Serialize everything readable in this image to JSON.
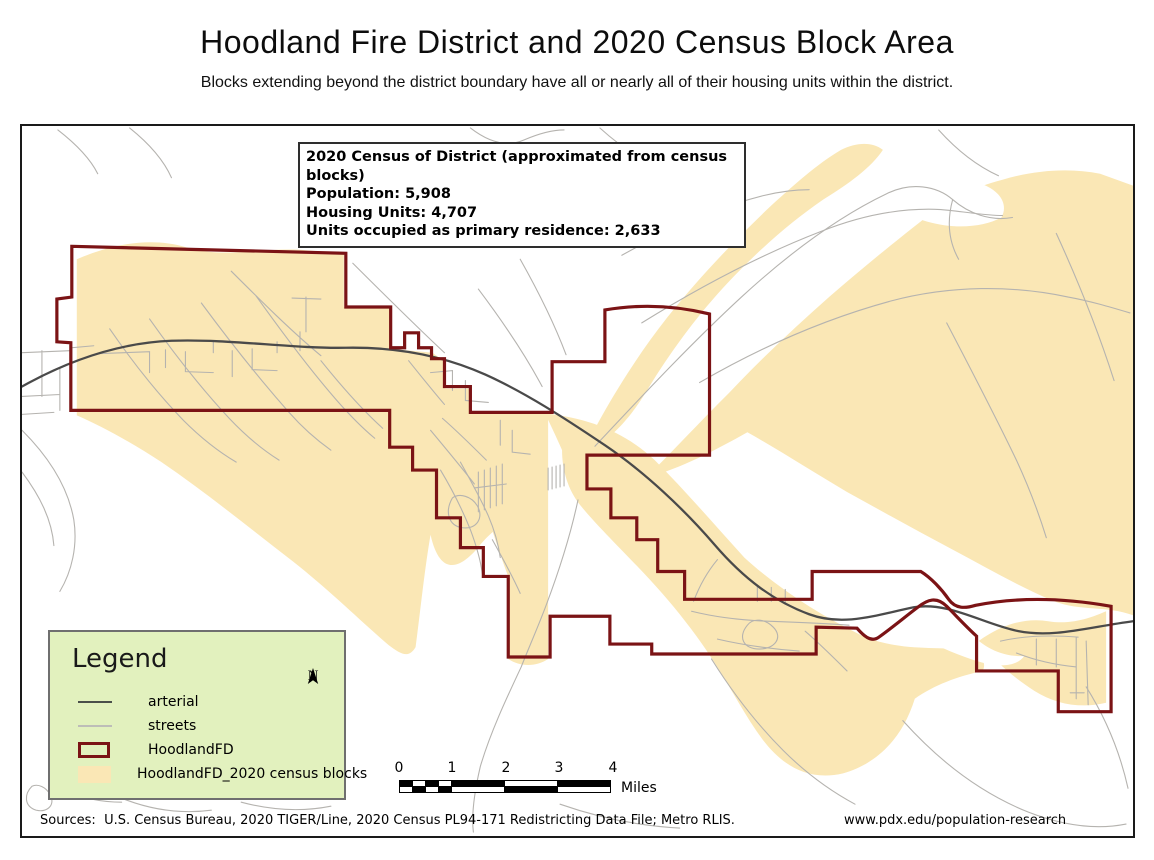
{
  "page": {
    "title": "Hoodland Fire District and 2020 Census Block Area",
    "subtitle": "Blocks extending beyond the district boundary have all or nearly all of their housing units within the district."
  },
  "map": {
    "info_box": {
      "heading": "2020 Census of District (approximated from census blocks)",
      "population": "Population: 5,908",
      "housing_units": "Housing Units: 4,707",
      "occupied": "Units occupied as primary residence: 2,633"
    },
    "legend": {
      "title": "Legend",
      "north_label": "N",
      "items": [
        {
          "label": "arterial",
          "swatch": "line-dark"
        },
        {
          "label": "streets",
          "swatch": "line-light"
        },
        {
          "label": "HoodlandFD",
          "swatch": "outline-maroon"
        },
        {
          "label": "HoodlandFD_2020 census blocks",
          "swatch": "fill-tan"
        }
      ]
    },
    "scale_bar": {
      "ticks": [
        "0",
        "1",
        "2",
        "3",
        "4"
      ],
      "unit": "Miles"
    },
    "footer": {
      "sources": "Sources:  U.S. Census Bureau, 2020 TIGER/Line, 2020 Census PL94-171 Redistricting Data File; Metro RLIS.",
      "website": "www.pdx.edu/population-research"
    }
  },
  "colors": {
    "census_blocks": "#FAE7B5",
    "district_boundary": "#7B1315",
    "arterial": "#4A4A4A",
    "streets": "#B5B3AF",
    "legend_background": "#E2F1BE"
  }
}
